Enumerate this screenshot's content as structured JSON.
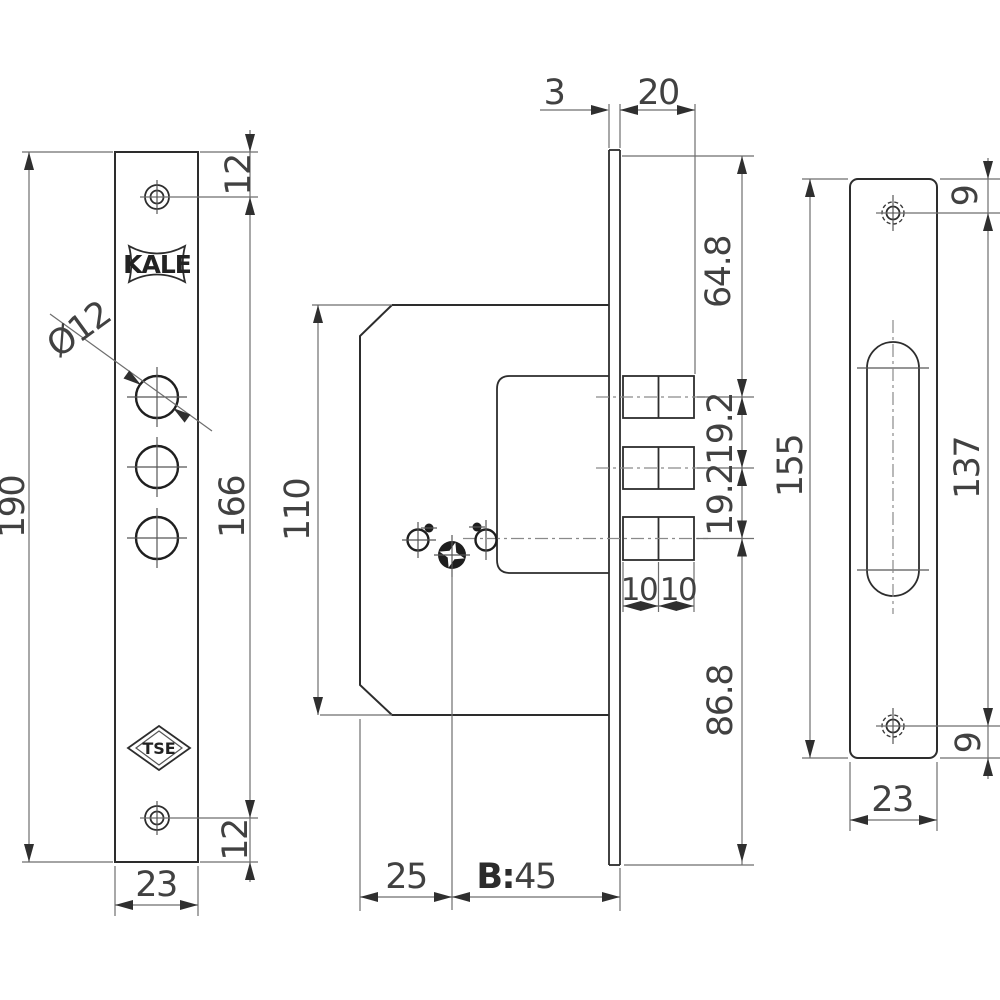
{
  "drawing": {
    "brand": "KALE",
    "certification": "TSE",
    "left_view": {
      "hole_diameter": "Ø12",
      "total_height": "190",
      "hole_span": "166",
      "top_hole_offset": "12",
      "bottom_hole_offset": "12",
      "plate_width": "23"
    },
    "middle_view": {
      "faceplate_thickness": "3",
      "bolt_throw": "20",
      "top_to_first_bolt": "64.8",
      "bolt_pitch_1": "19.2",
      "bolt_pitch_2": "19.2",
      "bolt_half_1": "10",
      "bolt_half_2": "10",
      "last_bolt_to_bottom": "86.8",
      "case_height": "110",
      "backset": "25",
      "case_depth_prefix": "B:",
      "case_depth_value": "45"
    },
    "right_view": {
      "total_height": "155",
      "slot_hole_span": "137",
      "top_hole_offset": "9",
      "bottom_hole_offset": "9",
      "plate_width": "23"
    }
  }
}
